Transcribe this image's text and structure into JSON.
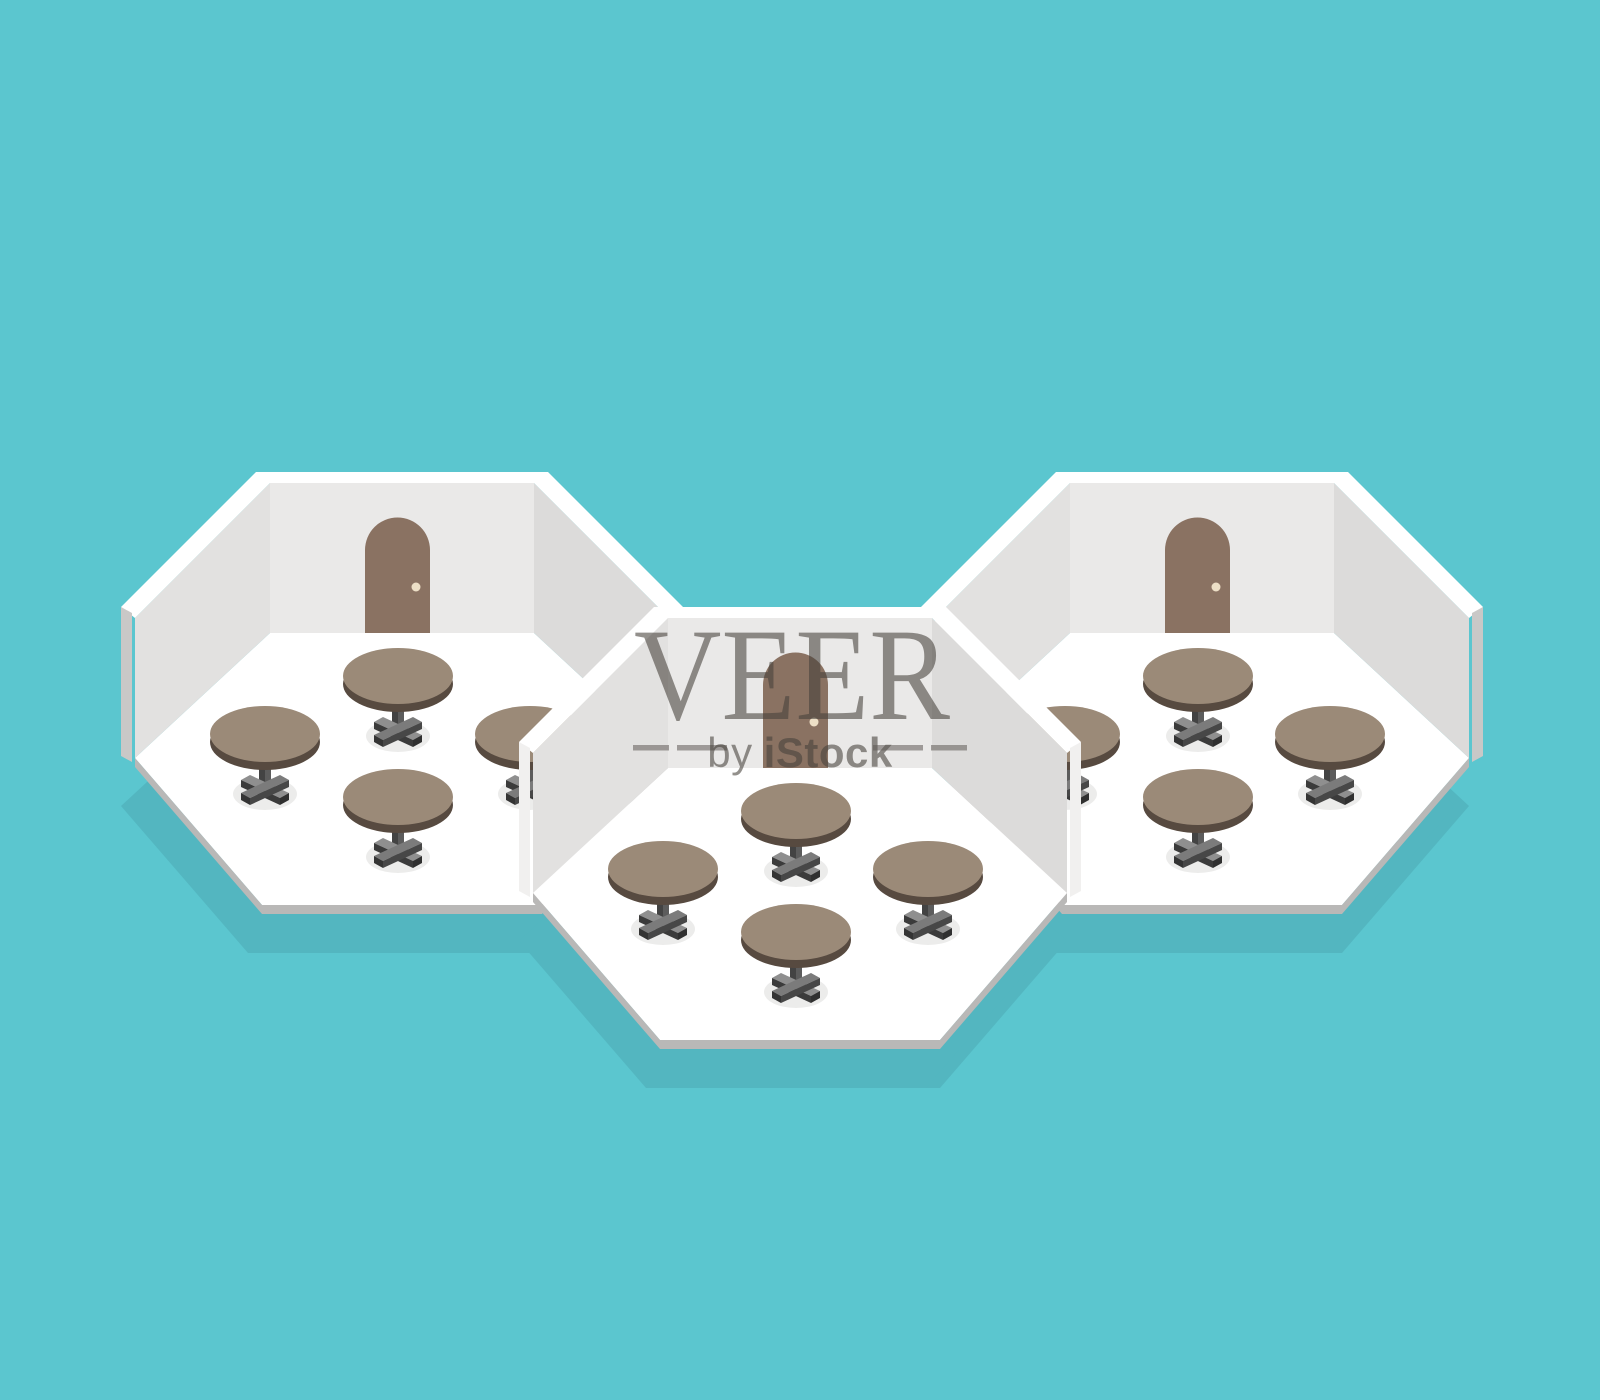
{
  "image": {
    "type": "isometric vector illustration (stock image preview)",
    "subject": "Three octagonal white cafe rooms, each with an arched door and four round pedestal tables, on a teal background"
  },
  "watermark": {
    "title": "VEER",
    "subtitle_prefix": "by",
    "subtitle_brand": "iStock",
    "color": "#46413B"
  },
  "scene": {
    "background_color": "#5BC6CF",
    "room_shadow_color": "#53B6C0",
    "floor_color": "#FFFFFF",
    "wall_rim_color": "#FFFFFF",
    "wall_back_color": "#EAE9E8",
    "wall_left_color": "#E2E1E0",
    "wall_right_color": "#DCDBDA",
    "wall_end_cap_color": "#C9C8C7",
    "wall_end_cap_color_center_room": "#F1F0EF",
    "floor_edge_color": "#B9B8B7",
    "door_color": "#8A7262",
    "doorknob_color": "#EDDFC6",
    "table_top_color": "#9B8A78",
    "table_edge_color": "#574A40",
    "table_floor_shadow_color": "#ECECEB",
    "rooms": [
      {
        "id": "left-room",
        "transform": "translate(0,0)",
        "table_count": 4,
        "door_count": 1
      },
      {
        "id": "right-room",
        "transform": "translate(800,0)",
        "table_count": 4,
        "door_count": 1
      },
      {
        "id": "center-room",
        "transform": "translate(398,135)",
        "table_count": 4,
        "door_count": 1
      }
    ]
  }
}
